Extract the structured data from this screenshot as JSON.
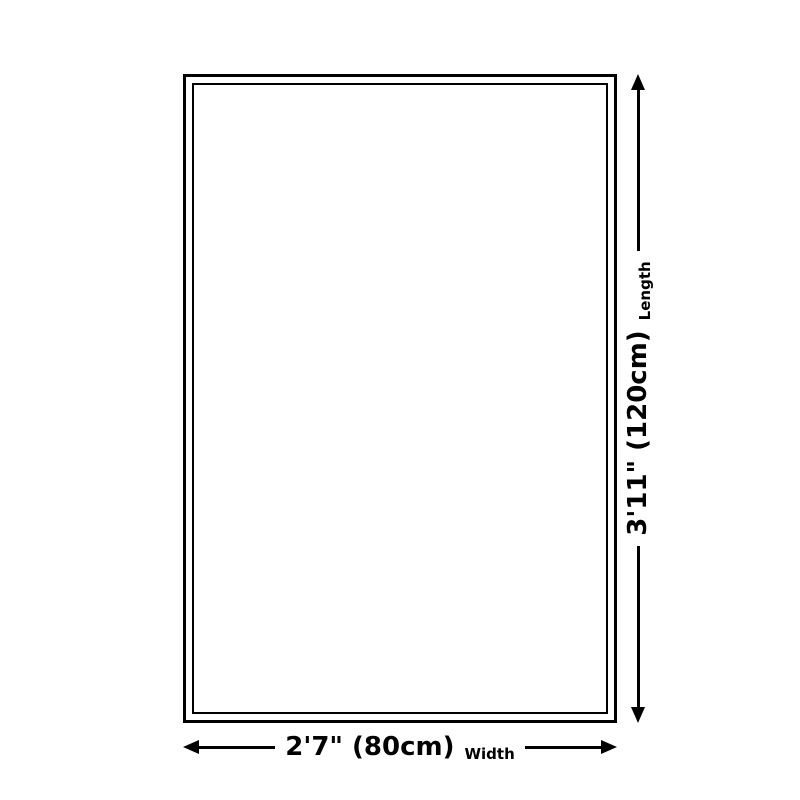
{
  "diagram": {
    "title": "rug-size-diagram"
  },
  "dimensions": {
    "length": {
      "value": "3'11\" (120cm)",
      "name": "Length"
    },
    "width": {
      "value": "2'7\" (80cm)",
      "name": "Width"
    }
  },
  "colors": {
    "line": "#000000",
    "background": "#ffffff"
  }
}
